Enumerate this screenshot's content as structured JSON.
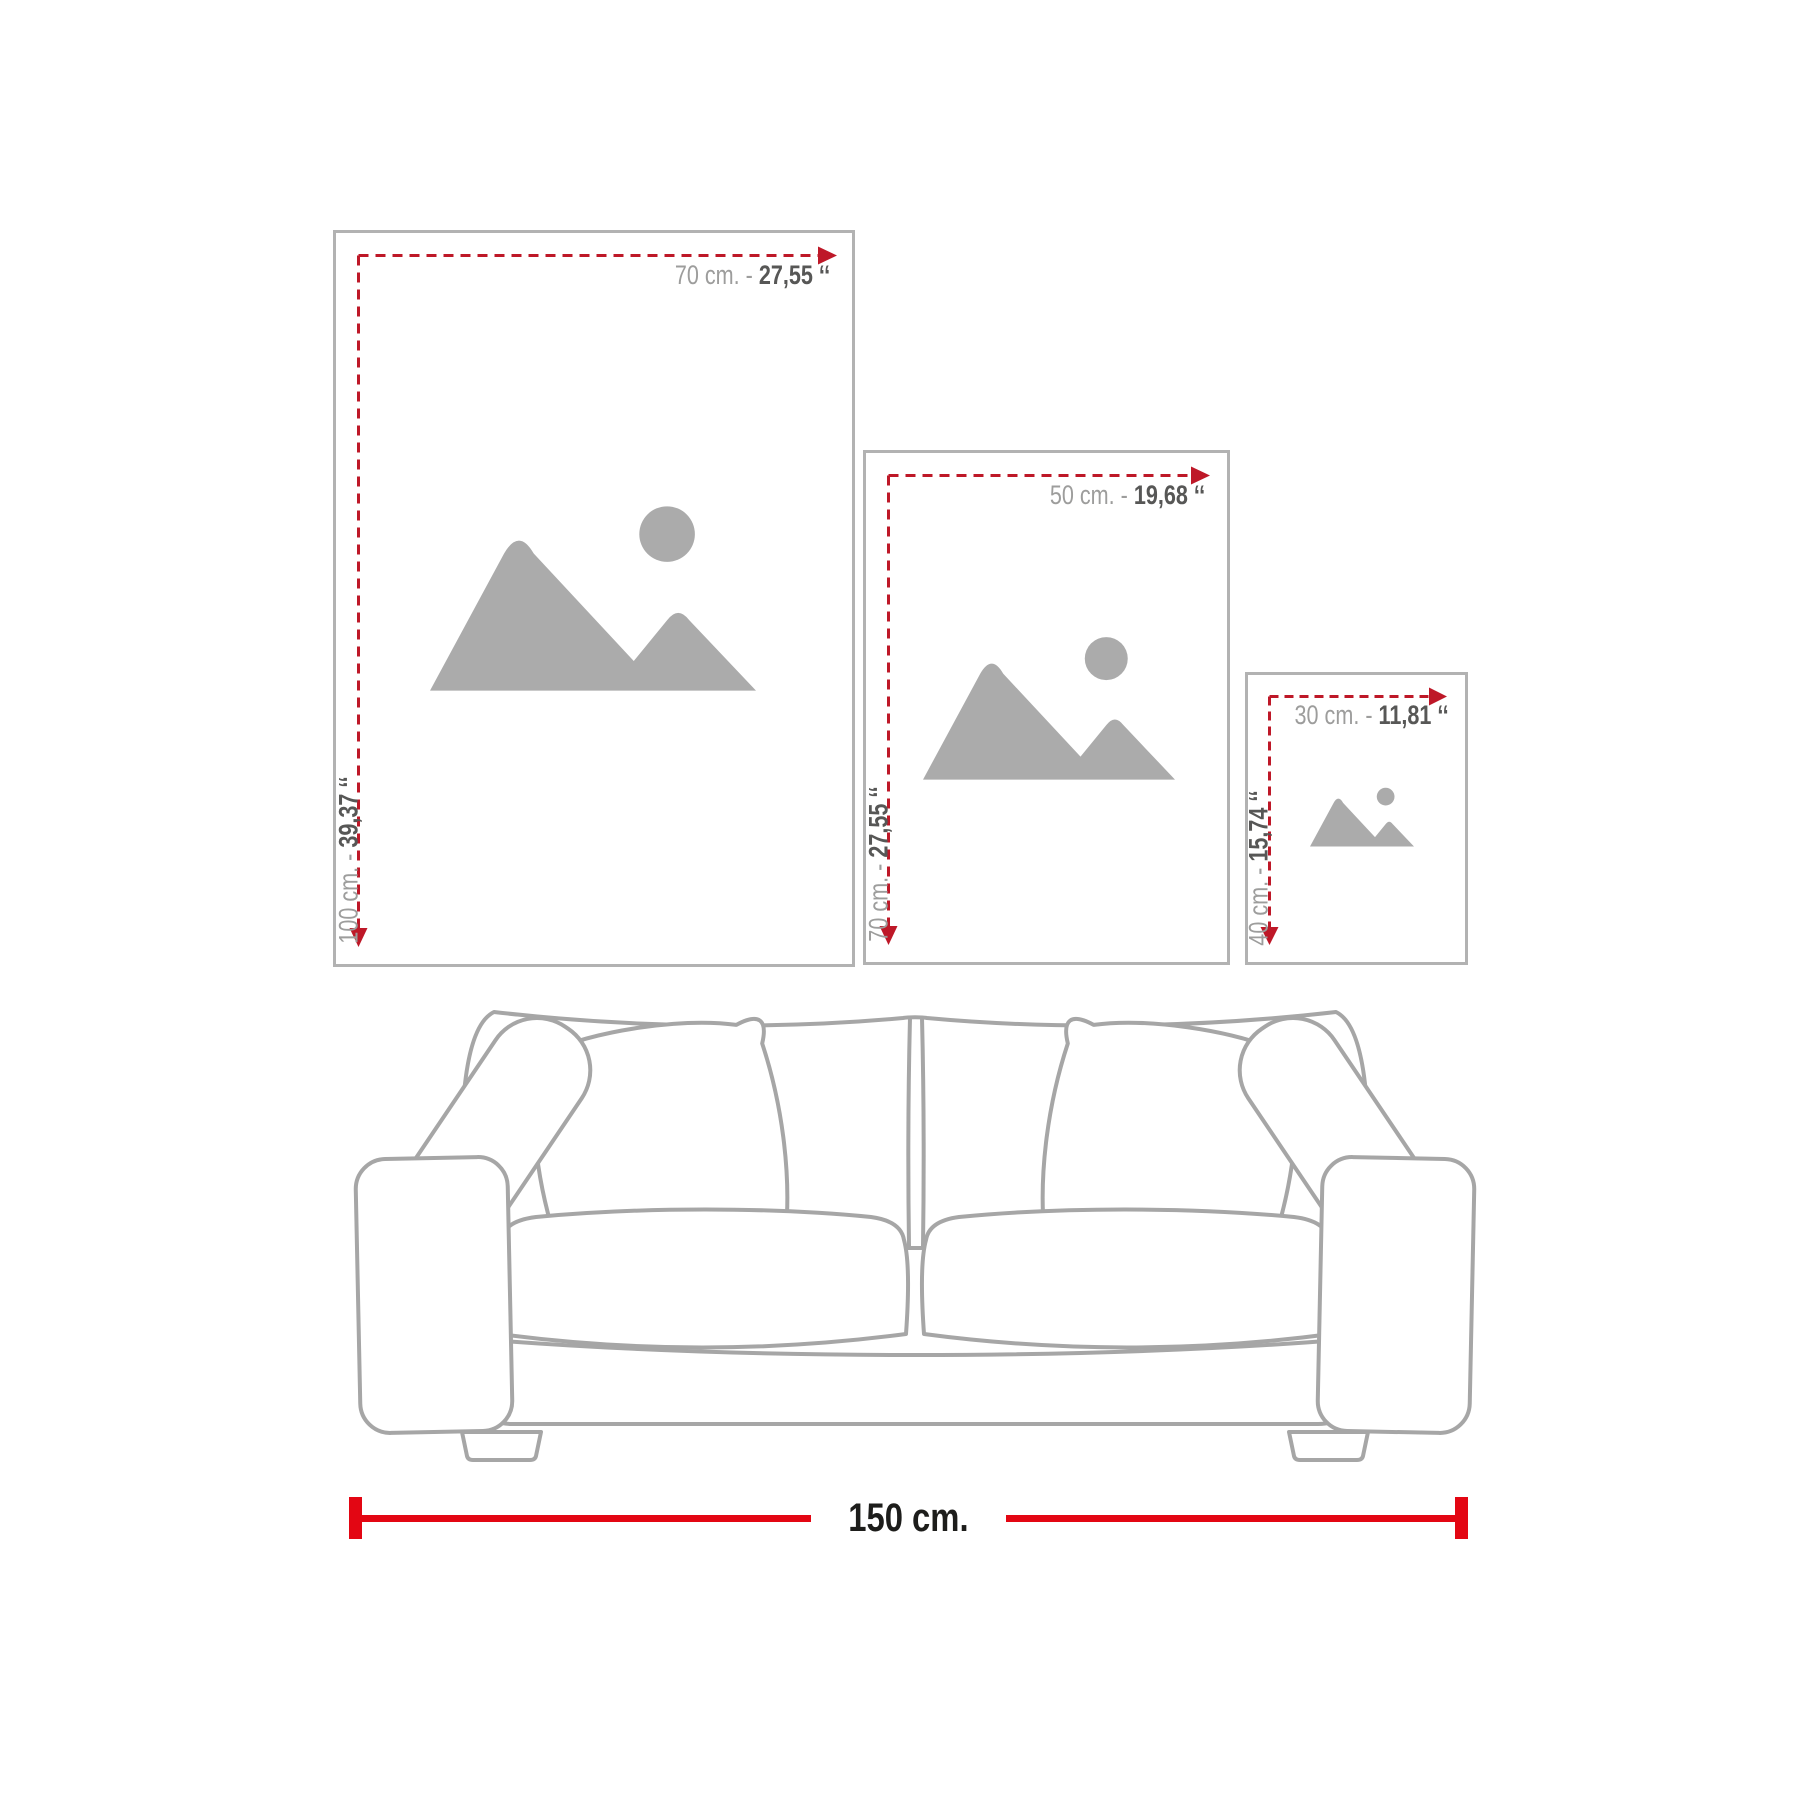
{
  "colors": {
    "dash_red": "#be1828",
    "bright_red": "#e30613",
    "frame_border": "#b2b2b2",
    "placeholder_gray": "#ababab",
    "label_light": "#9d9d9c",
    "label_dark": "#575756",
    "sofa_line": "#a6a6a6",
    "text_black": "#1d1d1b"
  },
  "frames": [
    {
      "size": "large",
      "width_cm": "70 cm. - ",
      "width_in": "27,55 ‘‘",
      "height_cm": "100 cm. - ",
      "height_in": "39,37 ‘‘"
    },
    {
      "size": "medium",
      "width_cm": "50 cm. - ",
      "width_in": "19,68 ‘‘",
      "height_cm": "70 cm. - ",
      "height_in": "27,55 ‘‘"
    },
    {
      "size": "small",
      "width_cm": "30 cm. - ",
      "width_in": "11,81 ‘‘",
      "height_cm": "40 cm. - ",
      "height_in": "15,74 ‘‘"
    }
  ],
  "sofa": {
    "width_label": "150 cm."
  },
  "icons": {
    "placeholder": "image-placeholder-icon",
    "arrow": "red-arrowhead"
  }
}
